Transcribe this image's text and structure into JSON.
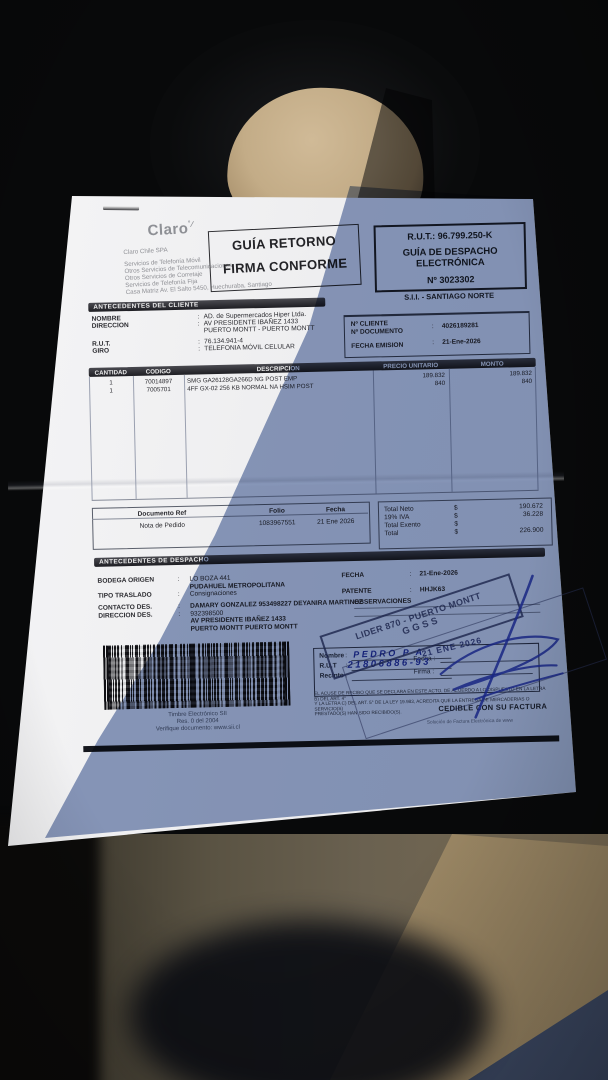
{
  "punct": {
    "colon": ":",
    "dollar": "$"
  },
  "header": {
    "logo": "Claro",
    "company_lines": [
      "Claro Chile SPA",
      "Servicios de Telefonía Móvil",
      "Otros Servicios de Telecomunicaciones",
      "Otros Servicios de Corretaje",
      "Servicios de Telefonía Fija",
      "Casa Matriz Av. El Salto 5450, Huechuraba, Santiago"
    ],
    "return_stamp_line1": "GUÍA RETORNO",
    "return_stamp_line2": "FIRMA CONFORME",
    "rut_box": {
      "rut": "R.U.T.: 96.799.250-K",
      "doc_type_line1": "GUÍA DE DESPACHO",
      "doc_type_line2": "ELECTRÓNICA",
      "number": "Nº 3023302"
    },
    "sii_office": "S.I.I. - SANTIAGO NORTE"
  },
  "client": {
    "section_title": "ANTECEDENTES DEL CLIENTE",
    "labels": {
      "nombre": "NOMBRE",
      "direccion": "DIRECCION",
      "rut": "R.U.T.",
      "giro": "GIRO"
    },
    "values": {
      "nombre": "AD. de Supermercados Hiper Ltda.",
      "direccion_1": "AV PRESIDENTE IBAÑEZ 1433",
      "direccion_2": "PUERTO MONTT -  PUERTO MONTT",
      "rut": "76.134.941-4",
      "giro": "TELEFONIA MÓVIL CELULAR"
    },
    "right": {
      "n_cliente_label": "Nº CLIENTE",
      "n_documento_label": "Nº DOCUMENTO",
      "fecha_emision_label": "FECHA EMISION",
      "n_cliente_value": "4026189281",
      "fecha_emision_value": "21-Ene-2026"
    }
  },
  "items": {
    "headers": [
      "CANTIDAD",
      "CODIGO",
      "DESCRIPCION",
      "PRECIO UNITARIO",
      "MONTO"
    ],
    "rows": [
      {
        "qty": "1",
        "code": "70014897",
        "desc": "SMG GA26128GA266D NG POST EMP",
        "unit": "189.832",
        "amount": "189.832"
      },
      {
        "qty": "1",
        "code": "7005701",
        "desc": "4FF GX-02 256 KB NORMAL NA HSIM POST",
        "unit": "840",
        "amount": "840"
      }
    ]
  },
  "doc_ref": {
    "headers": [
      "Documento Ref",
      "Folio",
      "Fecha"
    ],
    "row": [
      "Nota de Pedido",
      "1083967551",
      "21 Ene 2026"
    ]
  },
  "totals": {
    "neto_label": "Total Neto",
    "neto": "190.672",
    "iva_label": "19% IVA",
    "iva": "36.228",
    "exento_label": "Total Exento",
    "exento": "",
    "total_label": "Total",
    "total": "226.900"
  },
  "dispatch": {
    "section_title": "ANTECEDENTES DE DESPACHO",
    "bodega_label": "BODEGA ORIGEN",
    "bodega_1": "LO BOZA 441",
    "bodega_2": "PUDAHUEL  METROPOLITANA",
    "traslado_label": "TIPO TRASLADO",
    "traslado": "Consignaciones",
    "contacto_label": "CONTACTO DES.",
    "contacto": "DAMARY GONZALEZ 953498227 DEYANIRA MARTINEZ",
    "direccion_label": "DIRECCION DES.",
    "direccion_1": "932398500",
    "direccion_2": "AV PRESIDENTE IBAÑEZ 1433",
    "direccion_3": "PUERTO MONTT   PUERTO MONTT",
    "fecha_label": "FECHA",
    "fecha": "21-Ene-2026",
    "patente_label": "PATENTE",
    "patente": "HHJK63",
    "observaciones_label": "OBSERVACIONES"
  },
  "receipt": {
    "nombre_label": "Nombre",
    "rut_label": "R.U.T",
    "recinto_label": "Recinto",
    "fecha_label": "Fecha :",
    "firma_label": "Firma :",
    "handwritten_nombre": "PEDRO P A",
    "handwritten_rut": "21806886-93",
    "date_stamp": "21 ENE 2026"
  },
  "stamps": {
    "lider_line1": "LIDER 870 - PUERTO MONTT",
    "lider_line2": "GGSS"
  },
  "barcode_caption": [
    "Timbre Electrónico SII",
    "Res. 0 del 2004",
    "Verifique documento: www.sii.cl"
  ],
  "legal_lines": [
    "EL ACUSE DE RECIBO QUE SE DECLARA EN ESTE ACTO, DE ACUERDO A LO DISPUESTO EN LA LETRA B) DEL ART. 4°",
    "Y LA LETRA C) DEL ART. 5° DE LA LEY 19.983, ACREDITA QUE LA ENTREGA DE MERCADERIAS O SERVICIO(S)",
    "PRESTADO(S) HAN SIDO RECIBIDO(S)."
  ],
  "footer": {
    "cedible": "CEDIBLE CON SU FACTURA",
    "provider": "Solución de Factura Electrónica de www"
  }
}
